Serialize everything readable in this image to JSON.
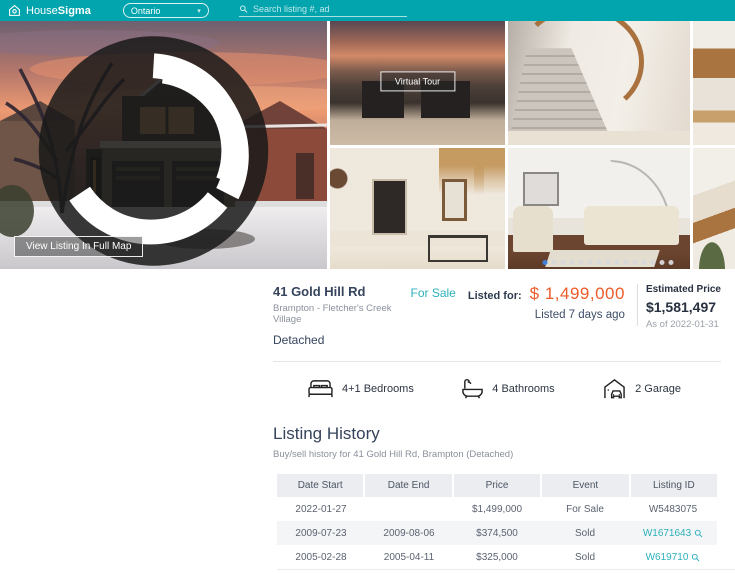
{
  "header": {
    "brand": {
      "name_regular": "House",
      "name_bold": "Sigma"
    },
    "region_selector": {
      "value": "Ontario"
    },
    "search": {
      "placeholder": "Search listing #, ad"
    }
  },
  "gallery": {
    "full_map_button": "View Listing In Full Map",
    "virtual_tour_button": "Virtual Tour",
    "carousel": {
      "count": 15,
      "active_index": 0
    }
  },
  "listing": {
    "address": "41 Gold Hill Rd",
    "community": "Brampton - Fletcher's Creek Village",
    "property_type": "Detached",
    "status": "For Sale",
    "listed_for_label": "Listed for:",
    "price": "$ 1,499,000",
    "listed_ago": "Listed 7 days ago",
    "estimated": {
      "label": "Estimated Price",
      "value": "$1,581,497",
      "as_of": "As of 2022-01-31"
    }
  },
  "facts": [
    {
      "icon": "bed-icon",
      "label": "4+1 Bedrooms"
    },
    {
      "icon": "bath-icon",
      "label": "4 Bathrooms"
    },
    {
      "icon": "garage-icon",
      "label": "2 Garage"
    }
  ],
  "history": {
    "title": "Listing History",
    "subtitle": "Buy/sell history for 41 Gold Hill Rd, Brampton (Detached)",
    "columns": [
      "Date Start",
      "Date End",
      "Price",
      "Event",
      "Listing ID"
    ],
    "rows": [
      {
        "date_start": "2022-01-27",
        "date_end": "",
        "price": "$1,499,000",
        "event": "For Sale",
        "listing_id": "W5483075"
      },
      {
        "date_start": "2009-07-23",
        "date_end": "2009-08-06",
        "price": "$374,500",
        "event": "Sold",
        "listing_id": "W1671643"
      },
      {
        "date_start": "2005-02-28",
        "date_end": "2005-04-11",
        "price": "$325,000",
        "event": "Sold",
        "listing_id": "W619710"
      }
    ]
  },
  "colors": {
    "brand_teal": "#02a5ae",
    "link_teal": "#2cb0ba",
    "accent_orange": "#ee5b2a",
    "navy_text": "#36445c",
    "active_dot_blue": "#3e7fd9"
  }
}
